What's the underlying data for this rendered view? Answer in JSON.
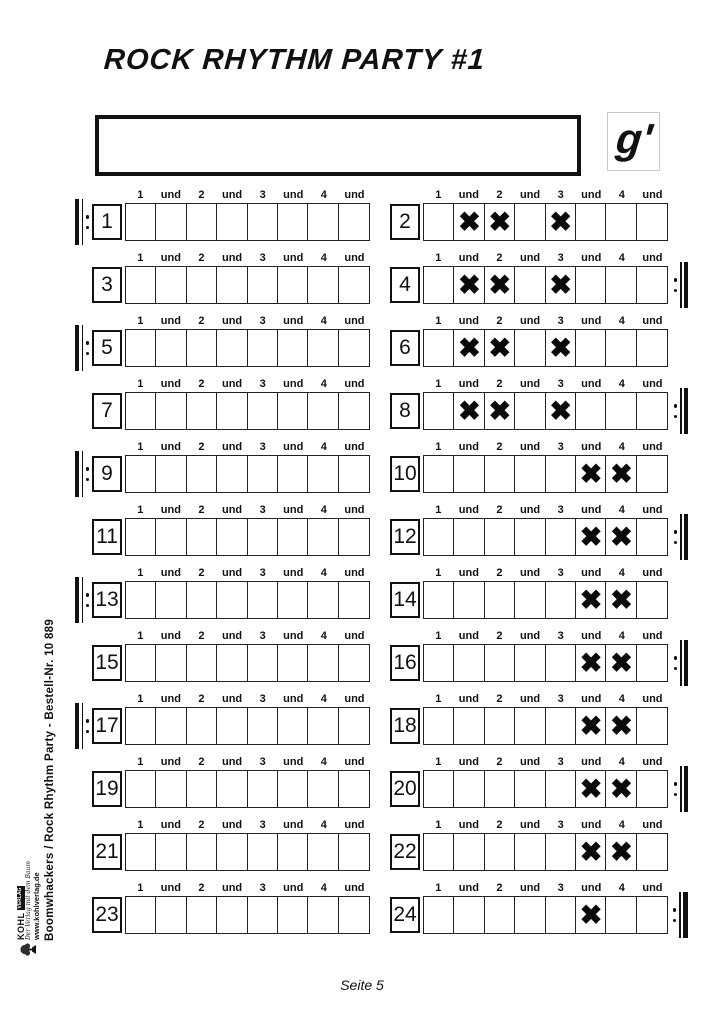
{
  "header": {
    "title": "ROCK RHYTHM PARTY #1",
    "note_label": "g'"
  },
  "beat_labels": [
    "1",
    "und",
    "2",
    "und",
    "3",
    "und",
    "4",
    "und"
  ],
  "mark_glyph": "✖",
  "footer": {
    "page_label": "Seite 5"
  },
  "sidebar": {
    "imprint": "Boomwhackers / Rock Rhythm Party   -   Bestell-Nr. 10 889",
    "logo_brand": "KOHL",
    "logo_brand_badge": "VERLAG",
    "logo_tagline": "Der Verlag mit dem Baum",
    "logo_url": "www.kohlverlag.de"
  },
  "measures": [
    {
      "number": "1",
      "begin_repeat": true,
      "end_repeat": false,
      "final": false,
      "marks": [
        0,
        0,
        0,
        0,
        0,
        0,
        0,
        0
      ]
    },
    {
      "number": "2",
      "begin_repeat": false,
      "end_repeat": false,
      "final": false,
      "marks": [
        0,
        1,
        1,
        0,
        1,
        0,
        0,
        0
      ]
    },
    {
      "number": "3",
      "begin_repeat": false,
      "end_repeat": false,
      "final": false,
      "marks": [
        0,
        0,
        0,
        0,
        0,
        0,
        0,
        0
      ]
    },
    {
      "number": "4",
      "begin_repeat": false,
      "end_repeat": true,
      "final": false,
      "marks": [
        0,
        1,
        1,
        0,
        1,
        0,
        0,
        0
      ]
    },
    {
      "number": "5",
      "begin_repeat": true,
      "end_repeat": false,
      "final": false,
      "marks": [
        0,
        0,
        0,
        0,
        0,
        0,
        0,
        0
      ]
    },
    {
      "number": "6",
      "begin_repeat": false,
      "end_repeat": false,
      "final": false,
      "marks": [
        0,
        1,
        1,
        0,
        1,
        0,
        0,
        0
      ]
    },
    {
      "number": "7",
      "begin_repeat": false,
      "end_repeat": false,
      "final": false,
      "marks": [
        0,
        0,
        0,
        0,
        0,
        0,
        0,
        0
      ]
    },
    {
      "number": "8",
      "begin_repeat": false,
      "end_repeat": true,
      "final": false,
      "marks": [
        0,
        1,
        1,
        0,
        1,
        0,
        0,
        0
      ]
    },
    {
      "number": "9",
      "begin_repeat": true,
      "end_repeat": false,
      "final": false,
      "marks": [
        0,
        0,
        0,
        0,
        0,
        0,
        0,
        0
      ]
    },
    {
      "number": "10",
      "begin_repeat": false,
      "end_repeat": false,
      "final": false,
      "marks": [
        0,
        0,
        0,
        0,
        0,
        1,
        1,
        0
      ]
    },
    {
      "number": "11",
      "begin_repeat": false,
      "end_repeat": false,
      "final": false,
      "marks": [
        0,
        0,
        0,
        0,
        0,
        0,
        0,
        0
      ]
    },
    {
      "number": "12",
      "begin_repeat": false,
      "end_repeat": true,
      "final": false,
      "marks": [
        0,
        0,
        0,
        0,
        0,
        1,
        1,
        0
      ]
    },
    {
      "number": "13",
      "begin_repeat": true,
      "end_repeat": false,
      "final": false,
      "marks": [
        0,
        0,
        0,
        0,
        0,
        0,
        0,
        0
      ]
    },
    {
      "number": "14",
      "begin_repeat": false,
      "end_repeat": false,
      "final": false,
      "marks": [
        0,
        0,
        0,
        0,
        0,
        1,
        1,
        0
      ]
    },
    {
      "number": "15",
      "begin_repeat": false,
      "end_repeat": false,
      "final": false,
      "marks": [
        0,
        0,
        0,
        0,
        0,
        0,
        0,
        0
      ]
    },
    {
      "number": "16",
      "begin_repeat": false,
      "end_repeat": true,
      "final": false,
      "marks": [
        0,
        0,
        0,
        0,
        0,
        1,
        1,
        0
      ]
    },
    {
      "number": "17",
      "begin_repeat": true,
      "end_repeat": false,
      "final": false,
      "marks": [
        0,
        0,
        0,
        0,
        0,
        0,
        0,
        0
      ]
    },
    {
      "number": "18",
      "begin_repeat": false,
      "end_repeat": false,
      "final": false,
      "marks": [
        0,
        0,
        0,
        0,
        0,
        1,
        1,
        0
      ]
    },
    {
      "number": "19",
      "begin_repeat": false,
      "end_repeat": false,
      "final": false,
      "marks": [
        0,
        0,
        0,
        0,
        0,
        0,
        0,
        0
      ]
    },
    {
      "number": "20",
      "begin_repeat": false,
      "end_repeat": true,
      "final": false,
      "marks": [
        0,
        0,
        0,
        0,
        0,
        1,
        1,
        0
      ]
    },
    {
      "number": "21",
      "begin_repeat": false,
      "end_repeat": false,
      "final": false,
      "marks": [
        0,
        0,
        0,
        0,
        0,
        0,
        0,
        0
      ]
    },
    {
      "number": "22",
      "begin_repeat": false,
      "end_repeat": false,
      "final": false,
      "marks": [
        0,
        0,
        0,
        0,
        0,
        1,
        1,
        0
      ]
    },
    {
      "number": "23",
      "begin_repeat": false,
      "end_repeat": false,
      "final": false,
      "marks": [
        0,
        0,
        0,
        0,
        0,
        0,
        0,
        0
      ]
    },
    {
      "number": "24",
      "begin_repeat": false,
      "end_repeat": true,
      "final": true,
      "marks": [
        0,
        0,
        0,
        0,
        0,
        1,
        0,
        0
      ]
    }
  ]
}
